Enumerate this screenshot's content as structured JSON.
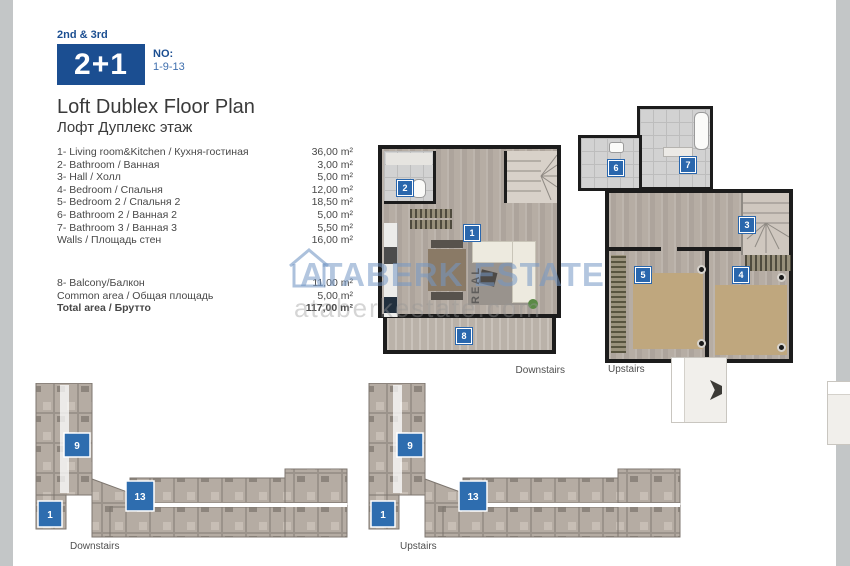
{
  "header": {
    "floors": "2nd & 3rd",
    "type": "2+1",
    "no_label": "NO:",
    "no_value": "1-9-13",
    "accent_color": "#1b4e91"
  },
  "title": {
    "en": "Loft Dublex Floor Plan",
    "ru": "Лофт Дуплекс этаж"
  },
  "rooms": {
    "items": [
      {
        "label": "1- Living room&Kitchen / Кухня-гостиная",
        "area": "36,00 m²"
      },
      {
        "label": "2- Bathroom / Ванная",
        "area": "3,00 m²"
      },
      {
        "label": "3- Hall / Холл",
        "area": "5,00 m²"
      },
      {
        "label": "4- Bedroom / Спальня",
        "area": "12,00 m²"
      },
      {
        "label": "5- Bedroom 2 / Спальня 2",
        "area": "18,50 m²"
      },
      {
        "label": "6- Bathroom 2 / Ванная 2",
        "area": "5,00 m²"
      },
      {
        "label": "7- Bathroom 3 / Ванная 3",
        "area": "5,50 m²"
      },
      {
        "label": "Walls / Площадь стен",
        "area": "16,00 m²"
      }
    ],
    "extras": [
      {
        "label": "8- Balcony/Балкон",
        "area": "11,00 m²"
      },
      {
        "label": "Common area / Общая площадь",
        "area": "5,00 m²"
      }
    ],
    "total": {
      "label": "Total area / Брутто",
      "area": "117,00 m²"
    }
  },
  "plans": {
    "downstairs_unit": {
      "caption": "Downstairs",
      "labels": {
        "living": "1",
        "bath": "2",
        "balcony": "8"
      }
    },
    "upstairs_unit": {
      "caption": "Upstairs",
      "labels": {
        "hall": "3",
        "bedroom": "4",
        "bedroom2": "5",
        "bath2": "6",
        "bath3": "7"
      }
    },
    "downstairs_floor": {
      "caption": "Downstairs",
      "labels": [
        "9",
        "13",
        "1"
      ]
    },
    "upstairs_floor": {
      "caption": "Upstairs",
      "labels": [
        "9",
        "13",
        "1"
      ]
    }
  },
  "watermark": {
    "brand": "ATABERK ESTATE",
    "real": "REAL",
    "site": "ataberkestate.com"
  }
}
